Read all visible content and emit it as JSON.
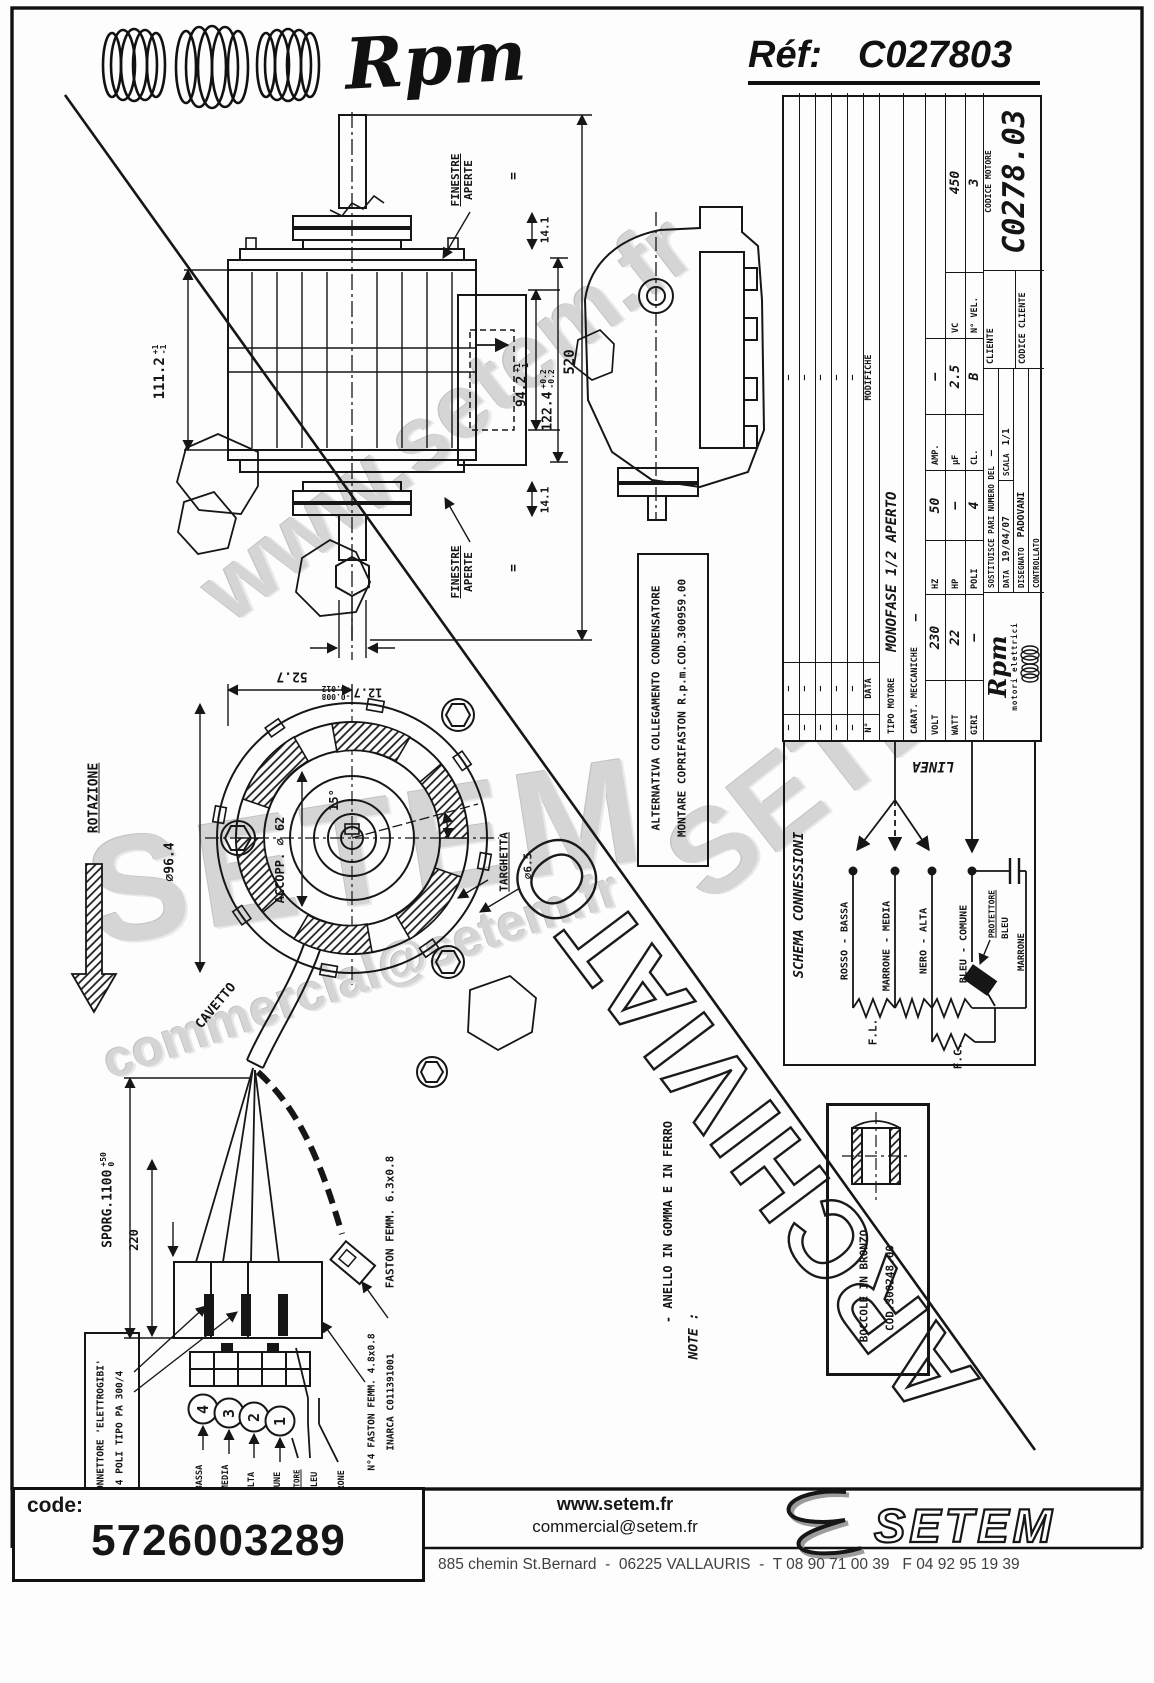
{
  "header": {
    "brand": "Rpm",
    "ref_label": "Réf:",
    "ref_value": "C027803"
  },
  "title_block": {
    "num_label": "N°",
    "data_col_label": "DATA",
    "modifiche_label": "MODIFICHE",
    "mod_rows": [
      [
        "–",
        "–",
        "–"
      ],
      [
        "–",
        "–",
        "–"
      ],
      [
        "–",
        "–",
        "–"
      ],
      [
        "–",
        "–",
        "–"
      ],
      [
        "–",
        "–",
        "–"
      ]
    ],
    "tipo_label": "TIPO MOTORE",
    "tipo_value": "MONOFASE 1/2 APERTO",
    "carat_label": "CARAT. MECCANICHE",
    "carat_value": "–",
    "volt_label": "VOLT",
    "volt_value": "230",
    "hz_label": "HZ",
    "hz_value": "50",
    "amp_label": "AMP.",
    "amp_value": "–",
    "watt_label": "WATT",
    "watt_value": "22",
    "hp_label": "HP",
    "hp_value": "–",
    "uf_label": "µF",
    "uf_value": "2.5",
    "vc_label": "VC",
    "vc_value": "450",
    "giri_label": "GIRI",
    "giri_value": "–",
    "poli_label": "POLI",
    "poli_value": "4",
    "cl_label": "CL.",
    "cl_value": "B",
    "nvel_label": "N° VEL.",
    "nvel_value": "3",
    "logo_text": "Rpm",
    "logo_sub": "motori elettrici",
    "sostituisce_label": "SOSTITUISCE PARI NUMERO DEL",
    "sostituisce_value": "–",
    "data_label": "DATA",
    "data_value": "19/04/07",
    "scala_label": "SCALA",
    "scala_value": "1/1",
    "disegnato_label": "DISEGNATO",
    "disegnato_value": "PADOVANI",
    "controllato_label": "CONTROLLATO",
    "cliente_label": "CLIENTE",
    "codice_cliente_label": "CODICE CLIENTE",
    "codice_motore_label": "CODICE MOTORE",
    "codice_motore_value": "C0278.03"
  },
  "side_view": {
    "len_value": "111.2",
    "len_tol_up": "+1",
    "len_tol_dn": "-1",
    "win_value": "94.2",
    "win_tol_up": "+1",
    "win_tol_dn": "-1",
    "body_value": "122.4",
    "body_tol_up": "+0.2",
    "body_tol_dn": "-0.2",
    "total_value": "520",
    "top_value": "14.1",
    "bottom_value": "14.1",
    "finestre_word1": "FINESTRE",
    "finestre_word2": "APERTE",
    "equals_mark": "=",
    "shaft_value": "12.7",
    "shaft_tol_up": "-0.008",
    "shaft_tol_dn": "-0.012"
  },
  "front_view": {
    "rotazione_label": "ROTAZIONE",
    "outer_dia": "∅96.4",
    "accopp_label": "ACCOPP. ∅ 62",
    "angle_value": "15°",
    "top_dim": "52.7",
    "targhetta_label": "TARGHETTA",
    "hole_dia": "∅6.5",
    "cavetto_label": "CAVETTO"
  },
  "cable_detail": {
    "sporg_value": "SPORG.1100",
    "sporg_tol_up": "+50",
    "sporg_tol_dn": "0",
    "len_220": "220",
    "faston_label": "FASTON FEMM. 6.3x0.8",
    "connettore_line1": "CONNETTORE 'ELETTROGIBI'",
    "connettore_line2": "4 POLI TIPO PA 300/4",
    "faston4_line1": "N°4 FASTON FEMM. 4.8x0.8",
    "faston4_line2": "INARCA C011391001",
    "pins": [
      "4",
      "3",
      "2",
      "1"
    ],
    "wires": [
      "ROSSO - BASSA",
      "MARRONE - MEDIA",
      "NERO - ALTA",
      "BLEU - COMUNE"
    ],
    "protettore_label": "PROTETTORE",
    "bleu_label": "BLEU",
    "marrone_label": "MARRONE"
  },
  "alternativa_box": {
    "line1": "ALTERNATIVA COLLEGAMENTO CONDENSATORE",
    "line2": "MONTARE COPRIFASTON R.p.m.COD.300959.00"
  },
  "schema": {
    "title": "SCHEMA CONNESSIONI",
    "linea_label": "LINEA",
    "wire1": "ROSSO - BASSA",
    "wire2": "MARRONE - MEDIA",
    "wire3": "NERO - ALTA",
    "wire4": "BLEU - COMUNE",
    "protettore_label": "PROTETTORE",
    "bleu_label": "BLEU",
    "marrone_label": "MARRONE",
    "fl_label": "F.L.",
    "fc_label": "F.C."
  },
  "note_box": {
    "title": "NOTE :",
    "line1": "- ANELLO IN GOMMA E IN FERRO"
  },
  "boccole_box": {
    "line1": "BOCCOLE IN BRONZO",
    "line2": "COD.300248.00"
  },
  "footer": {
    "code_label": "code:",
    "code_value": "5726003289",
    "site": "www.setem.fr",
    "email": "commercial@setem.fr",
    "brand": "SETEM",
    "address": "885 chemin St.Bernard  -  06225 VALLAURIS  -  T 08 90 71 00 39   F 04 92 95 19 39"
  },
  "watermarks": {
    "diag_site": "www.setem.fr",
    "diag_brand": "SETEM",
    "big_brand": "SETEM",
    "diag_email": "commercial@setem.fr",
    "stamp": "ARCHIVIATO"
  }
}
